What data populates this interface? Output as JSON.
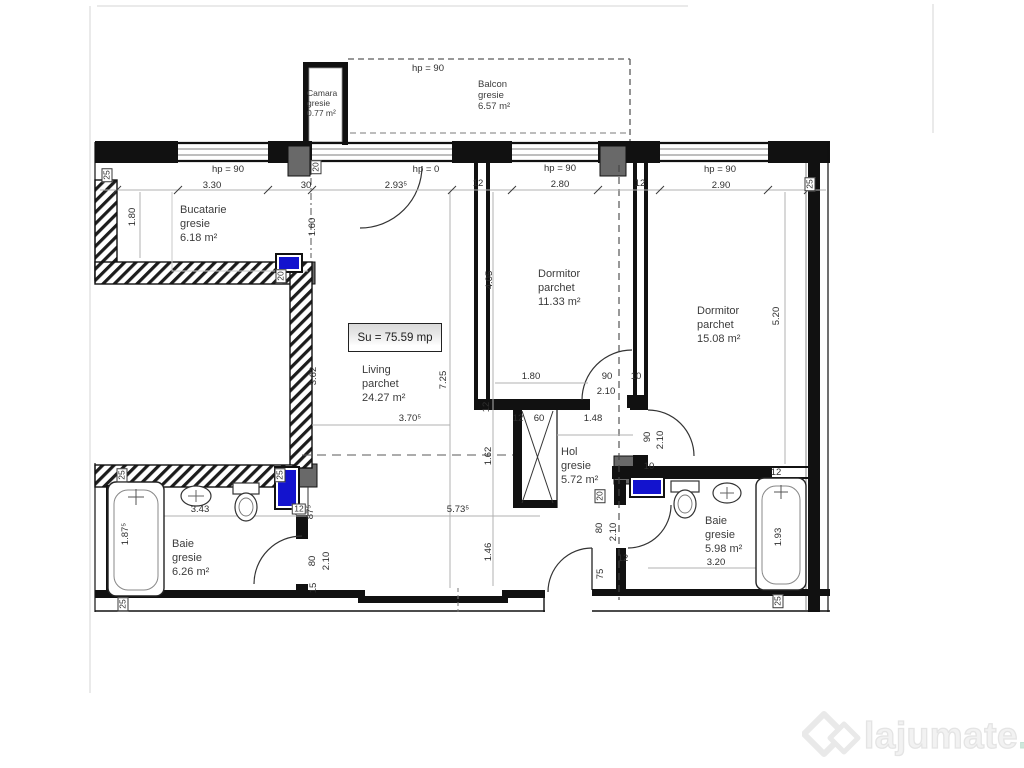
{
  "plan": {
    "summary_label": "Su = 75.59 mp",
    "rooms": [
      {
        "id": "camara",
        "lines": [
          "Camara",
          "gresie",
          "0.77 m²"
        ],
        "x": 307,
        "y": 88,
        "fs": 8.5,
        "lh": 10
      },
      {
        "id": "balcon",
        "lines": [
          "Balcon",
          "gresie",
          "6.57 m²"
        ],
        "x": 478,
        "y": 79,
        "fs": 9.5,
        "lh": 11
      },
      {
        "id": "bucatarie",
        "lines": [
          "Bucatarie",
          "gresie",
          "6.18 m²"
        ],
        "x": 180,
        "y": 203,
        "fs": 11,
        "lh": 14
      },
      {
        "id": "living",
        "lines": [
          "Living",
          "parchet",
          "24.27 m²"
        ],
        "x": 362,
        "y": 363,
        "fs": 11,
        "lh": 14
      },
      {
        "id": "dormitor-1",
        "lines": [
          "Dormitor",
          "parchet",
          "11.33 m²"
        ],
        "x": 538,
        "y": 267,
        "fs": 11,
        "lh": 14
      },
      {
        "id": "dormitor-2",
        "lines": [
          "Dormitor",
          "parchet",
          "15.08 m²"
        ],
        "x": 697,
        "y": 304,
        "fs": 11,
        "lh": 14
      },
      {
        "id": "hol",
        "lines": [
          "Hol",
          "gresie",
          "5.72 m²"
        ],
        "x": 561,
        "y": 445,
        "fs": 11,
        "lh": 14
      },
      {
        "id": "baie-1",
        "lines": [
          "Baie",
          "gresie",
          "6.26 m²"
        ],
        "x": 172,
        "y": 537,
        "fs": 11,
        "lh": 14
      },
      {
        "id": "baie-2",
        "lines": [
          "Baie",
          "gresie",
          "5.98 m²"
        ],
        "x": 705,
        "y": 514,
        "fs": 11,
        "lh": 14
      }
    ],
    "dimensions": [
      {
        "t": "hp = 90",
        "x": 428,
        "y": 69
      },
      {
        "t": "hp = 90",
        "x": 228,
        "y": 170
      },
      {
        "t": "3.30",
        "x": 212,
        "y": 186
      },
      {
        "t": "30",
        "x": 306,
        "y": 186
      },
      {
        "t": "hp = 0",
        "x": 426,
        "y": 170
      },
      {
        "t": "2.93⁵",
        "x": 396,
        "y": 186
      },
      {
        "t": "12",
        "x": 478,
        "y": 184
      },
      {
        "t": "hp = 90",
        "x": 560,
        "y": 169
      },
      {
        "t": "2.80",
        "x": 560,
        "y": 185
      },
      {
        "t": "12",
        "x": 640,
        "y": 184
      },
      {
        "t": "hp = 90",
        "x": 720,
        "y": 170
      },
      {
        "t": "2.90",
        "x": 721,
        "y": 186
      },
      {
        "t": "25",
        "x": 107,
        "y": 175,
        "r": 1,
        "b": 1
      },
      {
        "t": "25",
        "x": 810,
        "y": 184,
        "r": 1,
        "b": 1
      },
      {
        "t": "20",
        "x": 316,
        "y": 167,
        "r": 1,
        "b": 1
      },
      {
        "t": "1.80",
        "x": 133,
        "y": 217,
        "r": 1
      },
      {
        "t": "1.60",
        "x": 313,
        "y": 227,
        "r": 1
      },
      {
        "t": "20",
        "x": 281,
        "y": 276,
        "r": 1,
        "b": 1
      },
      {
        "t": "3.62",
        "x": 314,
        "y": 376,
        "r": 1
      },
      {
        "t": "7.25",
        "x": 444,
        "y": 380,
        "r": 1
      },
      {
        "t": "3.70⁵",
        "x": 410,
        "y": 419
      },
      {
        "t": "1.62",
        "x": 489,
        "y": 456,
        "r": 1
      },
      {
        "t": "5.73⁵",
        "x": 458,
        "y": 510
      },
      {
        "t": "1.46",
        "x": 489,
        "y": 552,
        "r": 1
      },
      {
        "t": "4.05",
        "x": 490,
        "y": 280,
        "r": 1
      },
      {
        "t": "1.80",
        "x": 531,
        "y": 377
      },
      {
        "t": "90",
        "x": 607,
        "y": 377
      },
      {
        "t": "2.10",
        "x": 606,
        "y": 392
      },
      {
        "t": "10",
        "x": 636,
        "y": 377
      },
      {
        "t": "12",
        "x": 487,
        "y": 407,
        "r": 1
      },
      {
        "t": "12",
        "x": 518,
        "y": 419
      },
      {
        "t": "60",
        "x": 539,
        "y": 419
      },
      {
        "t": "1.48",
        "x": 593,
        "y": 419
      },
      {
        "t": "20",
        "x": 600,
        "y": 496,
        "r": 1,
        "b": 1
      },
      {
        "t": "80",
        "x": 600,
        "y": 528,
        "r": 1
      },
      {
        "t": "2.10",
        "x": 614,
        "y": 532,
        "r": 1
      },
      {
        "t": "75",
        "x": 601,
        "y": 574,
        "r": 1
      },
      {
        "t": "12",
        "x": 623,
        "y": 559
      },
      {
        "t": "90",
        "x": 648,
        "y": 437,
        "r": 1
      },
      {
        "t": "2.10",
        "x": 661,
        "y": 440,
        "r": 1
      },
      {
        "t": "10",
        "x": 649,
        "y": 467
      },
      {
        "t": "5.20",
        "x": 777,
        "y": 316,
        "r": 1
      },
      {
        "t": "12",
        "x": 776,
        "y": 473
      },
      {
        "t": "1.93",
        "x": 779,
        "y": 537,
        "r": 1
      },
      {
        "t": "3.20",
        "x": 716,
        "y": 563
      },
      {
        "t": "25",
        "x": 778,
        "y": 601,
        "r": 1,
        "b": 1
      },
      {
        "t": "25",
        "x": 122,
        "y": 475,
        "r": 1,
        "b": 1
      },
      {
        "t": "25",
        "x": 280,
        "y": 475,
        "r": 1,
        "b": 1
      },
      {
        "t": "3.43",
        "x": 200,
        "y": 510
      },
      {
        "t": "1.87⁵",
        "x": 126,
        "y": 534,
        "r": 1
      },
      {
        "t": "12",
        "x": 299,
        "y": 509,
        "b": 1
      },
      {
        "t": "87⁵",
        "x": 311,
        "y": 512,
        "r": 1
      },
      {
        "t": "80",
        "x": 313,
        "y": 561,
        "r": 1
      },
      {
        "t": "2.10",
        "x": 327,
        "y": 561,
        "r": 1
      },
      {
        "t": "15",
        "x": 314,
        "y": 588,
        "r": 1
      },
      {
        "t": "25",
        "x": 123,
        "y": 604,
        "r": 1,
        "b": 1
      }
    ]
  },
  "colors": {
    "radiator_blue": "#1313ce",
    "pillar_gray": "#696969"
  },
  "watermark": {
    "name": "lajumate",
    "tld": ".ro"
  }
}
